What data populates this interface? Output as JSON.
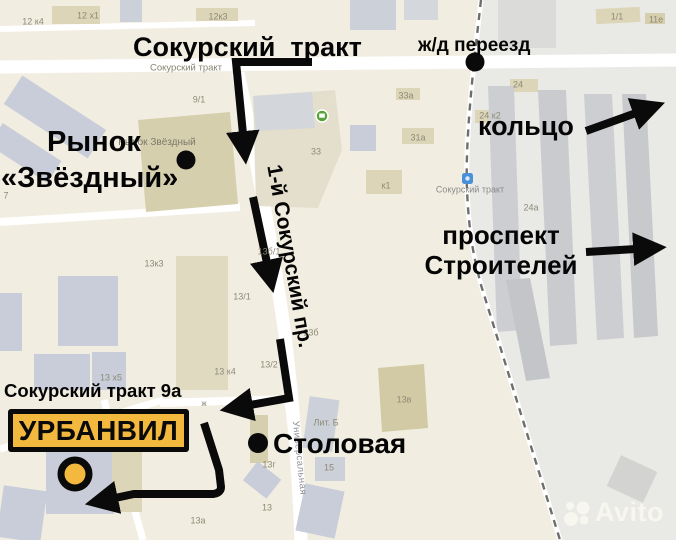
{
  "annotations": {
    "main_road": "Сокурский  тракт",
    "rail_crossing": "ж/д переезд",
    "ring": "кольцо",
    "prospect_line1": "проспект",
    "prospect_line2": "Строителей",
    "market_line1": "Рынок",
    "market_line2": "«Звёздный»",
    "side_street": "1-й Сокурский пр.",
    "address": "Сокурский тракт 9а",
    "place": "УРБАНВИЛ",
    "canteen": "Столовая"
  },
  "map_labels": [
    {
      "text": "12 к4"
    },
    {
      "text": "12 х1"
    },
    {
      "text": "12к3"
    },
    {
      "text": "1/1"
    },
    {
      "text": "11е"
    },
    {
      "text": "Сокурский тракт"
    },
    {
      "text": "9/1"
    },
    {
      "text": "33а"
    },
    {
      "text": "24"
    },
    {
      "text": "24 к2"
    },
    {
      "text": "33"
    },
    {
      "text": "31а"
    },
    {
      "text": "к1"
    },
    {
      "text": "Рынок Звёздный"
    },
    {
      "text": "Сокурский тракт"
    },
    {
      "text": "24а"
    },
    {
      "text": "7"
    },
    {
      "text": "13к3"
    },
    {
      "text": "13б/1"
    },
    {
      "text": "13/1"
    },
    {
      "text": "13б"
    },
    {
      "text": "13 к4"
    },
    {
      "text": "13/2"
    },
    {
      "text": "13 х5"
    },
    {
      "text": "ж"
    },
    {
      "text": "13в"
    },
    {
      "text": "Лит. Б"
    },
    {
      "text": "13г"
    },
    {
      "text": "15"
    },
    {
      "text": "Универсальная"
    },
    {
      "text": "13"
    },
    {
      "text": "13а"
    }
  ],
  "watermark": {
    "brand": "Avito"
  },
  "colors": {
    "accent_yellow": "#f3b83e",
    "route_black": "#0a0a0a",
    "map_beige": "#f1eee1",
    "map_gray_zone": "#e9e9e6",
    "bus_stop_blue": "#4a90d9",
    "poi_green": "#55a33a"
  }
}
